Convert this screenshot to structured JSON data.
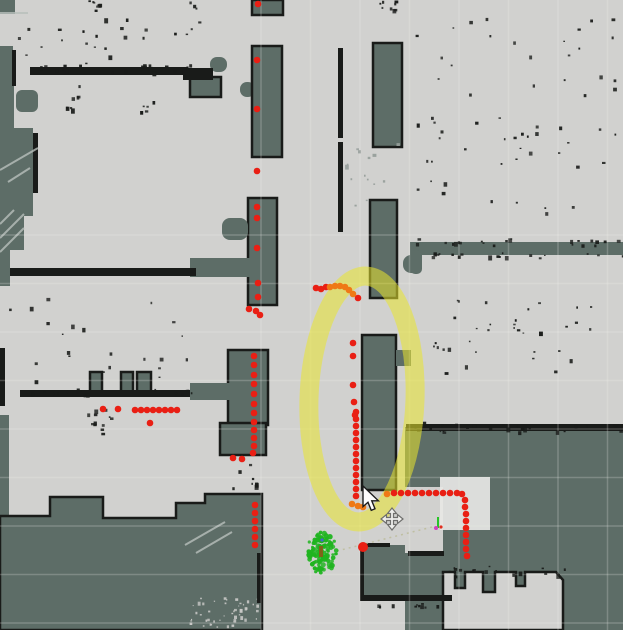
{
  "scene": {
    "width": 623,
    "height": 630,
    "colors": {
      "free": "#d1d1cf",
      "unknown": "#5d6d67",
      "wall": "#191b19",
      "scan_red": "#e91f14",
      "scan_orange": "#ef7916",
      "particle_green": "#1fb41f",
      "highlight_yellow": "#e9e52d",
      "costmap_white": "#e7e7e5",
      "grid_line": "#f2f2ee",
      "hatch_line": "#b9c0bc"
    }
  },
  "map": {
    "regions": [
      {
        "x": 0,
        "y": 0,
        "w": 15,
        "h": 14
      },
      {
        "x": 0,
        "y": 46,
        "w": 13,
        "h": 42
      },
      {
        "x": 0,
        "y": 84,
        "w": 14,
        "h": 48
      },
      {
        "x": 16,
        "y": 90,
        "w": 22,
        "h": 22,
        "rx": 6
      },
      {
        "x": 0,
        "y": 128,
        "w": 33,
        "h": 88
      },
      {
        "x": 0,
        "y": 214,
        "w": 24,
        "h": 36
      },
      {
        "x": 0,
        "y": 248,
        "w": 10,
        "h": 38
      },
      {
        "x": 0,
        "y": 415,
        "w": 9,
        "h": 102
      },
      {
        "x": 190,
        "y": 77,
        "w": 31,
        "h": 20,
        "stroke": true
      },
      {
        "x": 210,
        "y": 57,
        "w": 17,
        "h": 15,
        "rx": 7
      },
      {
        "x": 240,
        "y": 82,
        "w": 15,
        "h": 15,
        "rx": 7
      },
      {
        "x": 252,
        "y": 0,
        "w": 31,
        "h": 15,
        "stroke": true
      },
      {
        "x": 252,
        "y": 46,
        "w": 30,
        "h": 111,
        "stroke": true
      },
      {
        "x": 373,
        "y": 43,
        "w": 29,
        "h": 104,
        "stroke": true
      },
      {
        "x": 370,
        "y": 200,
        "w": 27,
        "h": 98,
        "stroke": true
      },
      {
        "x": 403,
        "y": 255,
        "w": 19,
        "h": 18,
        "rx": 8
      },
      {
        "x": 248,
        "y": 198,
        "w": 29,
        "h": 107,
        "stroke": true
      },
      {
        "x": 222,
        "y": 218,
        "w": 26,
        "h": 22,
        "rx": 8
      },
      {
        "x": 190,
        "y": 258,
        "w": 60,
        "h": 19
      },
      {
        "x": 228,
        "y": 350,
        "w": 40,
        "h": 75,
        "stroke": true
      },
      {
        "x": 220,
        "y": 423,
        "w": 46,
        "h": 32,
        "stroke": true
      },
      {
        "x": 362,
        "y": 335,
        "w": 34,
        "h": 155,
        "stroke": true
      },
      {
        "x": 396,
        "y": 350,
        "w": 15,
        "h": 16
      },
      {
        "x": 410,
        "y": 242,
        "w": 213,
        "h": 13
      },
      {
        "x": 410,
        "y": 250,
        "w": 12,
        "h": 24,
        "rx": 5
      },
      {
        "x": 190,
        "y": 383,
        "w": 42,
        "h": 17
      },
      {
        "x": 90,
        "y": 372,
        "w": 12,
        "h": 21,
        "stroke": true
      },
      {
        "x": 121,
        "y": 372,
        "w": 12,
        "h": 21,
        "stroke": true
      },
      {
        "x": 137,
        "y": 372,
        "w": 14,
        "h": 21,
        "stroke": true
      },
      {
        "x": 405,
        "y": 427,
        "w": 218,
        "h": 203
      },
      {
        "x": 360,
        "y": 545,
        "w": 90,
        "h": 53
      },
      {
        "x": 405,
        "y": 487,
        "w": 38,
        "h": 66,
        "c": "free"
      }
    ],
    "polygons": [
      {
        "pts": [
          [
            0,
            516
          ],
          [
            50,
            516
          ],
          [
            50,
            497
          ],
          [
            103,
            497
          ],
          [
            103,
            518
          ],
          [
            176,
            518
          ],
          [
            176,
            503
          ],
          [
            205,
            503
          ],
          [
            205,
            494
          ],
          [
            262,
            494
          ],
          [
            262,
            630
          ],
          [
            0,
            630
          ]
        ],
        "c": "unknown",
        "stroke": true
      },
      {
        "pts": [
          [
            443,
            572
          ],
          [
            455,
            572
          ],
          [
            455,
            588
          ],
          [
            465,
            588
          ],
          [
            465,
            572
          ],
          [
            483,
            572
          ],
          [
            483,
            592
          ],
          [
            495,
            592
          ],
          [
            495,
            572
          ],
          [
            516,
            572
          ],
          [
            516,
            586
          ],
          [
            525,
            586
          ],
          [
            525,
            572
          ],
          [
            556,
            572
          ],
          [
            563,
            580
          ],
          [
            563,
            630
          ],
          [
            443,
            630
          ]
        ],
        "c": "free",
        "stroke": true
      }
    ],
    "walls": [
      {
        "x": 12,
        "y": 50,
        "w": 4,
        "h": 36
      },
      {
        "x": 33,
        "y": 133,
        "w": 5,
        "h": 60
      },
      {
        "x": 30,
        "y": 67,
        "w": 158,
        "h": 8
      },
      {
        "x": 183,
        "y": 68,
        "w": 30,
        "h": 12
      },
      {
        "x": 10,
        "y": 268,
        "w": 186,
        "h": 8
      },
      {
        "x": 20,
        "y": 390,
        "w": 170,
        "h": 7
      },
      {
        "x": 0,
        "y": 348,
        "w": 5,
        "h": 58
      },
      {
        "x": 338,
        "y": 48,
        "w": 5,
        "h": 90
      },
      {
        "x": 338,
        "y": 142,
        "w": 5,
        "h": 90
      },
      {
        "x": 360,
        "y": 595,
        "w": 92,
        "h": 6
      },
      {
        "x": 257,
        "y": 553,
        "w": 6,
        "h": 50
      },
      {
        "x": 408,
        "y": 551,
        "w": 36,
        "h": 5
      },
      {
        "x": 406,
        "y": 424,
        "w": 217,
        "h": 7
      },
      {
        "x": 360,
        "y": 545,
        "w": 4,
        "h": 52
      },
      {
        "x": 360,
        "y": 543,
        "w": 30,
        "h": 4
      }
    ],
    "hatches": [
      [
        0,
        238,
        24,
        214
      ],
      [
        0,
        252,
        24,
        228
      ],
      [
        0,
        224,
        14,
        210
      ],
      [
        0,
        170,
        38,
        148
      ],
      [
        8,
        182,
        30,
        168
      ],
      [
        185,
        545,
        225,
        522
      ],
      [
        196,
        553,
        232,
        532
      ],
      [
        0,
        13,
        28,
        13
      ]
    ],
    "speckles": [
      {
        "x": 415,
        "y": 8,
        "w": 200,
        "h": 205,
        "n": 60,
        "seed": 11
      },
      {
        "x": 432,
        "y": 295,
        "w": 62,
        "h": 88,
        "n": 16,
        "seed": 12
      },
      {
        "x": 505,
        "y": 296,
        "w": 92,
        "h": 88,
        "n": 18,
        "seed": 13
      },
      {
        "x": 15,
        "y": 18,
        "w": 165,
        "h": 48,
        "n": 20,
        "seed": 14
      },
      {
        "x": 185,
        "y": 0,
        "w": 14,
        "h": 70,
        "n": 7,
        "seed": 15
      },
      {
        "x": 8,
        "y": 278,
        "w": 185,
        "h": 112,
        "n": 22,
        "seed": 16
      },
      {
        "x": 86,
        "y": 406,
        "w": 26,
        "h": 32,
        "n": 12,
        "seed": 17
      },
      {
        "x": 188,
        "y": 596,
        "w": 72,
        "h": 32,
        "n": 48,
        "seed": 18,
        "c": "#c8c8c6",
        "s": [
          1,
          3
        ]
      },
      {
        "x": 345,
        "y": 143,
        "w": 58,
        "h": 70,
        "n": 14,
        "seed": 19,
        "c": "#99a19d"
      },
      {
        "x": 405,
        "y": 421,
        "w": 218,
        "h": 11,
        "n": 30,
        "seed": 20
      },
      {
        "x": 410,
        "y": 238,
        "w": 213,
        "h": 7,
        "n": 22,
        "seed": 21
      },
      {
        "x": 410,
        "y": 252,
        "w": 213,
        "h": 6,
        "n": 20,
        "seed": 22
      },
      {
        "x": 30,
        "y": 64,
        "w": 160,
        "h": 8,
        "n": 24,
        "seed": 23
      },
      {
        "x": 20,
        "y": 388,
        "w": 172,
        "h": 6,
        "n": 18,
        "seed": 24
      },
      {
        "x": 443,
        "y": 565,
        "w": 122,
        "h": 11,
        "n": 18,
        "seed": 25
      },
      {
        "x": 375,
        "y": 599,
        "w": 62,
        "h": 8,
        "n": 12,
        "seed": 26
      },
      {
        "x": 88,
        "y": 0,
        "w": 16,
        "h": 12,
        "n": 8,
        "seed": 27
      },
      {
        "x": 370,
        "y": 0,
        "w": 28,
        "h": 10,
        "n": 8,
        "seed": 28
      },
      {
        "x": 140,
        "y": 100,
        "w": 18,
        "h": 18,
        "n": 6,
        "seed": 29
      },
      {
        "x": 55,
        "y": 85,
        "w": 25,
        "h": 25,
        "n": 8,
        "seed": 30
      },
      {
        "x": 230,
        "y": 463,
        "w": 30,
        "h": 26,
        "n": 8,
        "seed": 31
      }
    ]
  },
  "grid": {
    "x0": 261,
    "dx": 49.5,
    "y0": 235,
    "dy": 48.5,
    "opacity": 0.22
  },
  "annotations": {
    "highlight_ellipse": {
      "cx": 362,
      "cy": 399,
      "rx": 53,
      "ry": 123,
      "stroke_width": 19,
      "opacity": 0.55,
      "rotate": 2
    },
    "local_costmap": {
      "x": 440,
      "y": 477,
      "w": 50,
      "h": 53,
      "opacity": 0.92
    },
    "guide_line": {
      "x1": 337,
      "y1": 551,
      "x2": 436,
      "y2": 526
    },
    "pose_axis": {
      "x": 438,
      "y": 517
    },
    "scan_points": {
      "radius": 3.3,
      "red": [
        [
          258,
          4
        ],
        [
          257,
          60
        ],
        [
          257,
          109
        ],
        [
          257,
          171
        ],
        [
          257,
          207
        ],
        [
          257,
          218
        ],
        [
          257,
          248
        ],
        [
          258,
          283
        ],
        [
          258,
          297
        ],
        [
          249,
          309
        ],
        [
          256,
          311
        ],
        [
          260,
          315
        ],
        [
          316,
          288
        ],
        [
          321,
          289
        ],
        [
          326,
          287
        ],
        [
          358,
          298
        ],
        [
          353,
          343
        ],
        [
          353,
          356
        ],
        [
          353,
          385
        ],
        [
          354,
          402
        ],
        [
          355,
          415
        ],
        [
          254,
          356
        ],
        [
          254,
          365
        ],
        [
          254,
          375
        ],
        [
          254,
          384
        ],
        [
          254,
          394
        ],
        [
          254,
          404
        ],
        [
          254,
          413
        ],
        [
          254,
          422
        ],
        [
          254,
          430
        ],
        [
          254,
          438
        ],
        [
          254,
          446
        ],
        [
          253,
          453
        ],
        [
          233,
          458
        ],
        [
          242,
          459
        ],
        [
          255,
          505
        ],
        [
          255,
          513
        ],
        [
          255,
          521
        ],
        [
          255,
          529
        ],
        [
          255,
          537
        ],
        [
          255,
          545
        ],
        [
          103,
          409
        ],
        [
          118,
          409
        ],
        [
          135,
          410
        ],
        [
          141,
          410
        ],
        [
          147,
          410
        ],
        [
          153,
          410
        ],
        [
          159,
          410
        ],
        [
          165,
          410
        ],
        [
          171,
          410
        ],
        [
          177,
          410
        ],
        [
          150,
          423
        ],
        [
          356,
          412
        ],
        [
          356,
          419
        ],
        [
          356,
          426
        ],
        [
          356,
          433
        ],
        [
          356,
          440
        ],
        [
          356,
          447
        ],
        [
          356,
          454
        ],
        [
          356,
          461
        ],
        [
          356,
          468
        ],
        [
          356,
          475
        ],
        [
          356,
          482
        ],
        [
          356,
          489
        ],
        [
          356,
          496
        ],
        [
          394,
          493
        ],
        [
          401,
          493
        ],
        [
          408,
          493
        ],
        [
          415,
          493
        ],
        [
          422,
          493
        ],
        [
          429,
          493
        ],
        [
          436,
          493
        ],
        [
          443,
          493
        ],
        [
          450,
          493
        ],
        [
          457,
          493
        ],
        [
          462,
          494
        ],
        [
          465,
          500
        ],
        [
          465,
          507
        ],
        [
          466,
          514
        ],
        [
          466,
          521
        ],
        [
          466,
          528
        ],
        [
          466,
          535
        ],
        [
          466,
          542
        ],
        [
          466,
          549
        ],
        [
          467,
          556
        ]
      ],
      "big_red": [
        [
          363,
          547
        ]
      ],
      "orange": [
        [
          330,
          287
        ],
        [
          335,
          286
        ],
        [
          340,
          286
        ],
        [
          345,
          287
        ],
        [
          349,
          290
        ],
        [
          353,
          294
        ],
        [
          387,
          494
        ],
        [
          352,
          504
        ],
        [
          358,
          506
        ],
        [
          363,
          507
        ]
      ]
    },
    "particle_cloud": {
      "cx": 322,
      "cy": 553,
      "rx": 15,
      "ry": 21,
      "n": 110,
      "seed": 77,
      "inner_mark": {
        "x": 319,
        "y": 546,
        "w": 4,
        "h": 11,
        "c": "#8a5a18"
      },
      "blue_dot": {
        "x": 322,
        "y": 540,
        "c": "#4466cc"
      }
    }
  },
  "cursor": {
    "pointer_tip": [
      363,
      486
    ],
    "move_tool_center": [
      392,
      519
    ]
  }
}
